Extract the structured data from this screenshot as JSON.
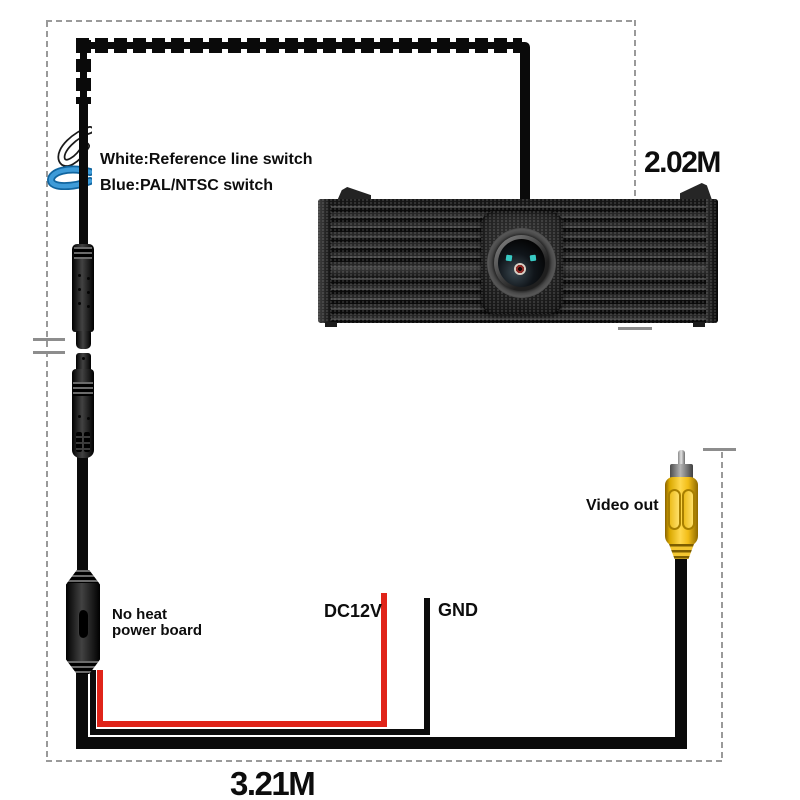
{
  "diagram": {
    "labels": {
      "switch_white": "White:Reference line switch",
      "switch_blue": "Blue:PAL/NTSC switch",
      "length_camera": "2.02M",
      "video_out": "Video out",
      "power_board_line1": "No heat",
      "power_board_line2": "power board",
      "wire_power": "DC12V",
      "wire_ground": "GND",
      "length_total": "3.21M"
    },
    "colors": {
      "cable": "#0a0a0a",
      "dash": "#9a9a9a",
      "wire_red": "#e02419",
      "rca_yellow": "#f7c22a",
      "switch_blue_loop": "#3e9bd8",
      "lens_dot_cyan": "#38c9c3"
    }
  }
}
